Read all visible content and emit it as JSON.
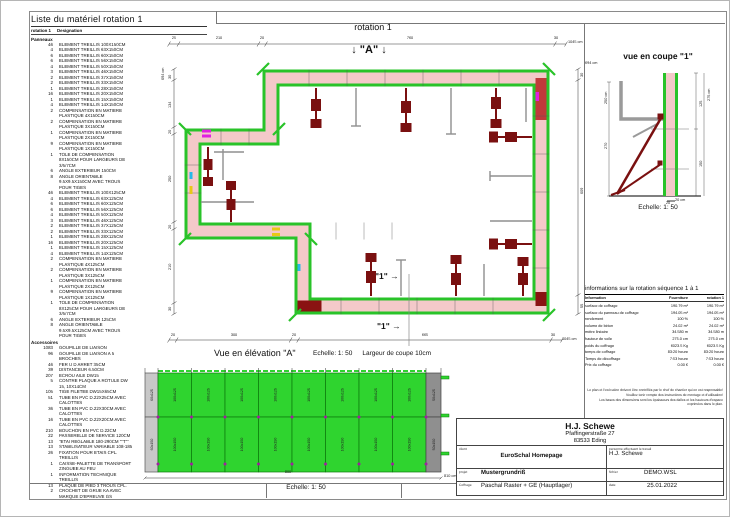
{
  "material_list": {
    "title": "Liste du matériel  rotation 1",
    "header": {
      "col1": "rotation 1",
      "col2": "Designation"
    },
    "sections": [
      {
        "name": "Panneaux",
        "items": [
          {
            "q": "46",
            "t": "ELEMENT TREILLIS 100X150CM"
          },
          {
            "q": "4",
            "t": "ELEMENT TREILLIS 63X150CM"
          },
          {
            "q": "6",
            "t": "ELEMENT TREILLIS 60X150CM"
          },
          {
            "q": "6",
            "t": "ELEMENT TREILLIS 56X150CM"
          },
          {
            "q": "4",
            "t": "ELEMENT TREILLIS 50X150CM"
          },
          {
            "q": "3",
            "t": "ELEMENT TREILLIS 46X150CM"
          },
          {
            "q": "2",
            "t": "ELEMENT TREILLIS 37X150CM"
          },
          {
            "q": "2",
            "t": "ELEMENT TREILLIS 33X150CM"
          },
          {
            "q": "1",
            "t": "ELEMENT TREILLIS 28X150CM"
          },
          {
            "q": "16",
            "t": "ELEMENT TREILLIS 20X150CM"
          },
          {
            "q": "1",
            "t": "ELEMENT TREILLIS 15X150CM"
          },
          {
            "q": "4",
            "t": "ELEMENT TREILLIS 14X150CM"
          },
          {
            "q": "2",
            "t": "COMPENSATION EN MATIERE PLASTIQUE 4X150CM"
          },
          {
            "q": "2",
            "t": "COMPENSATION EN MATIERE PLASTIQUE 3X150CM"
          },
          {
            "q": "1",
            "t": "COMPENSATION EN MATIERE PLASTIQUE 2X150CM"
          },
          {
            "q": "9",
            "t": "COMPENSATION EN MATIERE PLASTIQUE 1X150CM"
          },
          {
            "q": "1",
            "t": "TOLE DE COMPENSATION 8X150CM POUR LARGEURS DE 3/5/7CM"
          },
          {
            "q": "6",
            "t": "ANGLE EXTERIEUR 150CM"
          },
          {
            "q": "8",
            "t": "ANGLE ORIENTABLE 9.5X9.5X150CM AVEC TROUS POUR TIGES"
          },
          {
            "q": "46",
            "t": "ELEMENT TREILLIS 100X125CM"
          },
          {
            "q": "4",
            "t": "ELEMENT TREILLIS 63X125CM"
          },
          {
            "q": "6",
            "t": "ELEMENT TREILLIS 60X125CM"
          },
          {
            "q": "6",
            "t": "ELEMENT TREILLIS 56X125CM"
          },
          {
            "q": "4",
            "t": "ELEMENT TREILLIS 50X125CM"
          },
          {
            "q": "3",
            "t": "ELEMENT TREILLIS 46X125CM"
          },
          {
            "q": "2",
            "t": "ELEMENT TREILLIS 37X125CM"
          },
          {
            "q": "2",
            "t": "ELEMENT TREILLIS 33X125CM"
          },
          {
            "q": "1",
            "t": "ELEMENT TREILLIS 28X125CM"
          },
          {
            "q": "16",
            "t": "ELEMENT TREILLIS 20X125CM"
          },
          {
            "q": "1",
            "t": "ELEMENT TREILLIS 15X125CM"
          },
          {
            "q": "4",
            "t": "ELEMENT TREILLIS 14X125CM"
          },
          {
            "q": "2",
            "t": "COMPENSATION EN MATIERE PLASTIQUE 4X125CM"
          },
          {
            "q": "2",
            "t": "COMPENSATION EN MATIERE PLASTIQUE 3X125CM"
          },
          {
            "q": "1",
            "t": "COMPENSATION EN MATIERE PLASTIQUE 2X125CM"
          },
          {
            "q": "9",
            "t": "COMPENSATION EN MATIERE PLASTIQUE 1X125CM"
          },
          {
            "q": "1",
            "t": "TOLE DE COMPENSATION 8X125CM POUR LARGEURS DE 3/5/7CM"
          },
          {
            "q": "6",
            "t": "ANGLE EXTERIEUR 125CM"
          },
          {
            "q": "8",
            "t": "ANGLE ORIENTABLE 9.5X9.5X125CM AVEC TROUS POUR TIGES"
          }
        ]
      },
      {
        "name": "Accessoires",
        "items": [
          {
            "q": "1083",
            "t": "GOUPILLE DE LIAISON"
          },
          {
            "q": "96",
            "t": "GOUPILLE DE LIAISON A 5 BROCHES"
          },
          {
            "q": "46",
            "t": "FER U D ARRET 35CM"
          },
          {
            "q": "39",
            "t": "DISTANCEUR 6.50CM"
          },
          {
            "q": "207",
            "t": "ECROU AILE DW15"
          },
          {
            "q": "5",
            "t": "CONTRE PLAQUE A ROTULE DW 15, 10X14CM"
          },
          {
            "q": "105",
            "t": "TIGE FILETEE DW15X65CM"
          },
          {
            "q": "51",
            "t": "TUBE EN PVC D.22X25CM AVEC CALOTTES"
          },
          {
            "q": "36",
            "t": "TUBE EN PVC D.22X30CM AVEC CALOTTES"
          },
          {
            "q": "16",
            "t": "TUBE EN PVC D.22X20CM AVEC CALOTTES"
          },
          {
            "q": "210",
            "t": "BOUCHON EN PVC D.22CM"
          },
          {
            "q": "22",
            "t": "PASSERELLE DE SERVICE 120CM"
          },
          {
            "q": "13",
            "t": "\"ETAI REGLABLE 180-290CM \"\"T\"\""
          },
          {
            "q": "13",
            "t": "STABILISATEUR VARIABLE 108-185"
          },
          {
            "q": "26",
            "t": "FIXATION POUR ETAIS CPL. TREILLIS"
          },
          {
            "q": "1",
            "t": "CAISSE-PALETTE DE TRANSPORT ZINGUEE AU FEU"
          },
          {
            "q": "1",
            "t": "INFORMATION TECHNIQUE TREILLIS"
          },
          {
            "q": "13",
            "t": "PLAQUE DE PIED 3 TROUS CPL."
          },
          {
            "q": "2",
            "t": "CROCHET DE GRUE KA AVEC MARQUE D'EPREUVE GS"
          }
        ]
      }
    ]
  },
  "plan": {
    "title": "rotation 1",
    "a_label": "↓ \"A\" ↓",
    "cut_label": "\"1\" →",
    "dims": {
      "top": {
        "segments": [
          "25",
          "210",
          "20",
          "760",
          "30"
        ],
        "total": "1045 cm"
      },
      "bottom": {
        "segments": [
          "20",
          "300",
          "20",
          "665",
          "30"
        ],
        "total": "1045 cm"
      },
      "left": {
        "segments": [
          "30",
          "134",
          "20",
          "250",
          "20",
          "210",
          "30"
        ],
        "total": "694 cm"
      },
      "right": {
        "segments": [
          "30",
          "609",
          "55"
        ],
        "total": "694 cm"
      }
    }
  },
  "coupe": {
    "title": "vue en coupe \"1\"",
    "echelle": "Echelle: 1: 50",
    "dims": {
      "left_total": "250 cm",
      "left_seg": "270",
      "right_total": "275 cm",
      "right_top": "125",
      "right_bottom": "150",
      "scale_seg": "20",
      "scale_unit": "20 cm"
    }
  },
  "info_table": {
    "title": "informations sur la rotation  séquence 1 à 1",
    "columns": [
      "Information",
      "Fourniture",
      "rotation 1"
    ],
    "rows": [
      {
        "label": "surface de coffrage",
        "fourniture": "190.79 m²",
        "rotation1": "190.79 m²"
      },
      {
        "label": "surface du panneau de coffrage",
        "fourniture": "194.05 m²",
        "rotation1": "194.05 m²"
      },
      {
        "label": "rendement",
        "fourniture": "100 %",
        "rotation1": "100 %"
      },
      {
        "label": "volume de béton",
        "fourniture": "24.02 m³",
        "rotation1": "24.02 m³"
      },
      {
        "label": "mètre linéaire",
        "fourniture": "34.580 m",
        "rotation1": "34.580 m"
      },
      {
        "label": "hauteur de voile",
        "fourniture": "275.0 cm",
        "rotation1": "275.0 cm"
      },
      {
        "label": "poids du coffrage",
        "fourniture": "6023.5 Kg",
        "rotation1": "6023.5 Kg"
      },
      {
        "label": "temps de coffrage",
        "fourniture": "83:20 heure",
        "rotation1": "83:20 heure"
      },
      {
        "label": "Temps de décoffrage",
        "fourniture": "7:53 heure",
        "rotation1": "7:53 heure"
      },
      {
        "label": "Prix du coffrage",
        "fourniture": "0.00 €",
        "rotation1": "0.00 €"
      }
    ]
  },
  "disclaimer": [
    "Le plan et l'exécution doivent être contrôlés par le chef de chantier qui en est responsable!",
    "Veuillez tenir compte des instructions de montage et d'utilisation!",
    "Les bases des dimensions sont les épaisseurs des dalles et les hauteurs d'espace exprimées dans le plan."
  ],
  "elevation": {
    "title": "Vue en élévation \"A\"",
    "echelle_top": "Echelle: 1: 50",
    "largeur": "Largeur de coupe 10cm",
    "echelle_bottom": "Echelle: 1: 50",
    "dim_span": "800",
    "dim_total": "810 cm",
    "columns": [
      {
        "type": "light",
        "top": "60x125",
        "bottom": "60x150"
      },
      {
        "type": "green",
        "top": "100x125",
        "bottom": "100x150"
      },
      {
        "type": "green",
        "top": "100x125",
        "bottom": "100x150"
      },
      {
        "type": "green",
        "top": "100x125",
        "bottom": "100x150"
      },
      {
        "type": "green",
        "top": "100x125",
        "bottom": "100x150"
      },
      {
        "type": "green",
        "top": "100x125",
        "bottom": "100x150"
      },
      {
        "type": "green",
        "top": "100x125",
        "bottom": "100x150"
      },
      {
        "type": "green",
        "top": "100x125",
        "bottom": "100x150"
      },
      {
        "type": "green",
        "top": "100x125",
        "bottom": "100x150"
      },
      {
        "type": "dark",
        "top": "50x125",
        "bottom": "50x150"
      }
    ]
  },
  "title_block": {
    "company": "H.J. Schewe",
    "street": "Pfaffingerstraße 27",
    "city": "83533 Eding",
    "client_label": "client",
    "client": "EuroSchal Homepage",
    "worker_label": "personne effectuant le travail",
    "worker": "H.J. Schewe",
    "project_label": "projet",
    "project": "Mustergrundriß",
    "file_label": "fichier",
    "file": "DEMO.WSL",
    "coffrage_label": "Coffrage",
    "coffrage": "Paschal Raster + GE (Hauptlager)",
    "date_label": "date",
    "date": "25.01.2022"
  },
  "colors": {
    "wall_pink": "#f4c9c9",
    "formwork_green": "#29c329",
    "elevation_green": "#2fd42f",
    "brace_maroon": "#7a1010",
    "accent_red": "#c03a3a"
  }
}
